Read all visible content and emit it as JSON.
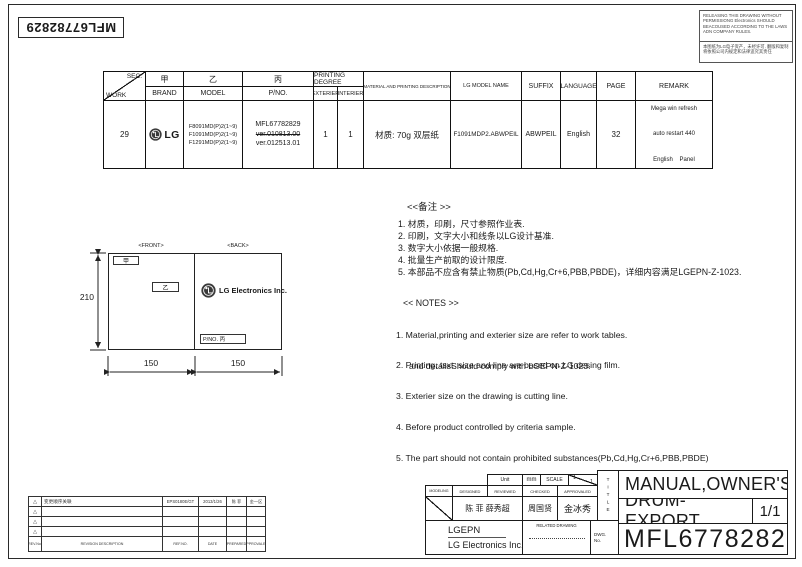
{
  "sheet": {
    "part_number_rotated": "MFL67782829"
  },
  "notice": {
    "english": "RELEASING THIS DRAWING WITHOUT PERMISSIONG Electronics SHOULD BEACOUSED ACCORDING TO THE LAWS ADN COMPANY RULES.",
    "chinese": "本图纸为LG电子资产，未经许可. 翻版和复制将依照公司内规定和法律追究其责任"
  },
  "work_table": {
    "headers": {
      "sec": "SEC.",
      "work": "WORK",
      "jia": "甲",
      "brand": "BRAND",
      "yi": "乙",
      "model": "MODEL",
      "bing": "丙",
      "pno": "P/NO.",
      "printing_degree": "PRINTING DEGREE",
      "exterier": "EXTERIER",
      "interier": "INTERIER",
      "material": "MATERIAL AND PRINTING DESCRIPTION",
      "lg_model_name": "LG MODEL NAME",
      "suffix": "SUFFIX",
      "language": "LANGUAGE",
      "page": "PAGE",
      "remark": "REMARK"
    },
    "row": {
      "work": "29",
      "brand": "LG",
      "models": [
        "F8091MD(P)2(1~9)",
        "F1091MD(P)2(1~9)",
        "F1291MD(P)2(1~9)"
      ],
      "pno": "MFL67782829",
      "pno_old_version": "ver.010813.00",
      "pno_version": "ver.012513.01",
      "exterier": "1",
      "interier": "1",
      "material": "材质: 70g 双层纸",
      "lg_model_name": "F1091MDP2.ABWPEIL",
      "suffix": "ABWPEIL",
      "language": "English",
      "page": "32",
      "remark_lines": [
        "Mega win refresh",
        "auto restart 440",
        "English    Panel"
      ]
    }
  },
  "drawing": {
    "front_label": "<FRONT>",
    "back_label": "<BACK>",
    "tag_jia": "甲",
    "tag_yi": "乙",
    "logo_text": "LG Electronics Inc.",
    "pno_tag": "P/NO. 丙",
    "dim_height": "210",
    "dim_width_front": "150",
    "dim_width_back": "150"
  },
  "remarks_cn": {
    "title": "<<备注 >>",
    "items": [
      "1.  材质，印刷，尺寸参照作业表.",
      "2.  印刷，文字大小和线条以LG设计基准.",
      "3.  数字大小依据一般规格.",
      "4.  批量生产前取的设计限度.",
      "5.  本部品不应含有禁止物质(Pb,Cd,Hg,Cr+6,PBB,PBDE)，详细内容满足LGEPN-Z-1023."
    ]
  },
  "notes_en": {
    "title": "<< NOTES >>",
    "items": [
      "1. Material,printing and exterier size are refer to work tables.",
      "2. Printing, tsxt  size and line are based on LG desing film.",
      "3. Exterier size on the drawing is cutting line.",
      "4. Before product controlled by criteria sample.",
      "5. The part should not contain prohibited substances(Pb,Cd,Hg,Cr+6,PBB,PBDE)"
    ],
    "item5_continuation": "and detailsShould comply with LGEPN-Z-1023."
  },
  "revision_table": {
    "headers": {
      "rev_no": "REV.No.",
      "description": "REVISION DESCRIPTION",
      "ref_no": "REF.NO.",
      "date": "DATE",
      "prepared": "PREPARED",
      "approvaled": "APPROVALED"
    },
    "rows": [
      {
        "marker": "△",
        "description": "变更顺序关联",
        "ref_no": "EPS0180E/GT",
        "date": "2013/1/26",
        "prepared": "陈 菲",
        "approvaled": "金一区"
      },
      {
        "marker": "△",
        "description": "",
        "ref_no": "",
        "date": "",
        "prepared": "",
        "approvaled": ""
      },
      {
        "marker": "△",
        "description": "",
        "ref_no": "",
        "date": "",
        "prepared": "",
        "approvaled": ""
      },
      {
        "marker": "△",
        "description": "",
        "ref_no": "",
        "date": "",
        "prepared": "",
        "approvaled": ""
      }
    ]
  },
  "title_block": {
    "unit_label": "Unit",
    "unit_value": "mm",
    "scale_label": "SCALE",
    "scale_top": "1",
    "scale_bottom": "1",
    "modeling_label": "MODELING",
    "designed_label": "DESIGNED",
    "reviewed_label": "REVIEWED",
    "checked_label": "CHECKED",
    "approvaled_label": "APPROVALED",
    "designed_sign": "陈 菲 薛秀超",
    "checked_sign": "周国贤",
    "approvaled_sign": "金冰秀",
    "company_short": "LGEPN",
    "company_full": "LG Electronics Inc.",
    "related_drawing_label": "RELATED DRAWING",
    "dwg_label_1": "DWG.",
    "dwg_label_2": "No.",
    "title_vertical": "TITLE",
    "title_line1": "MANUAL,OWNER'S",
    "title_line2": "DRUM-EXPORT",
    "sheet": "1/1",
    "drawing_number": "MFL67782829"
  },
  "colors": {
    "ink": "#1a1a1a",
    "paper": "#ffffff",
    "logo_dark": "#3a3a3a"
  }
}
